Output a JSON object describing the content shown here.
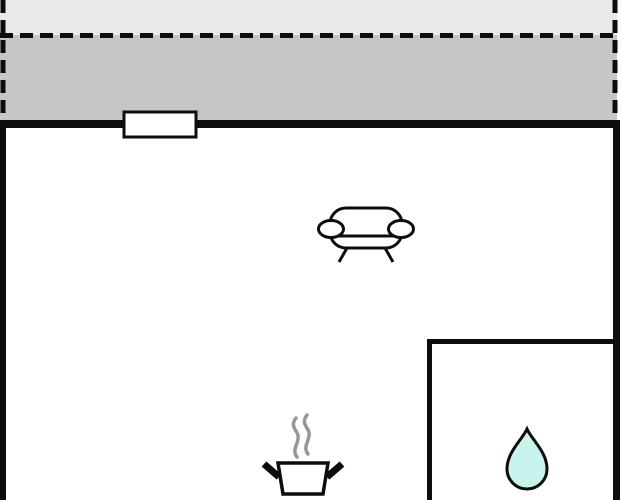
{
  "floorplan": {
    "kind": "holiday-home floor plan (no text labels visible)",
    "colors": {
      "background": "#ffffff",
      "wall": "#0d0d0d",
      "terrace_upper": "#e9e9e9",
      "terrace_lower": "#c6c6c6",
      "room_fill": "#ffffff",
      "window_fill": "#ffffff",
      "steam": "#979797",
      "water_drop": "#c8f4ee"
    },
    "regions": [
      {
        "id": "terrace",
        "boundary": "dashed outline, shaded grey, outside top wall"
      },
      {
        "id": "main-room",
        "boundary": "solid black walls, white fill"
      },
      {
        "id": "bathroom",
        "boundary": "thin interior walls, bottom-right corner"
      }
    ],
    "features": [
      {
        "id": "window-opening",
        "location": "top wall, left of centre"
      }
    ],
    "icons": [
      {
        "id": "sofa-icon",
        "meaning": "sofa / living area"
      },
      {
        "id": "steam-icon",
        "meaning": "steam above cooking pot"
      },
      {
        "id": "cooking-pot-icon",
        "meaning": "kitchen / cooking facility"
      },
      {
        "id": "water-drop-icon",
        "meaning": "water / bathroom"
      }
    ]
  }
}
